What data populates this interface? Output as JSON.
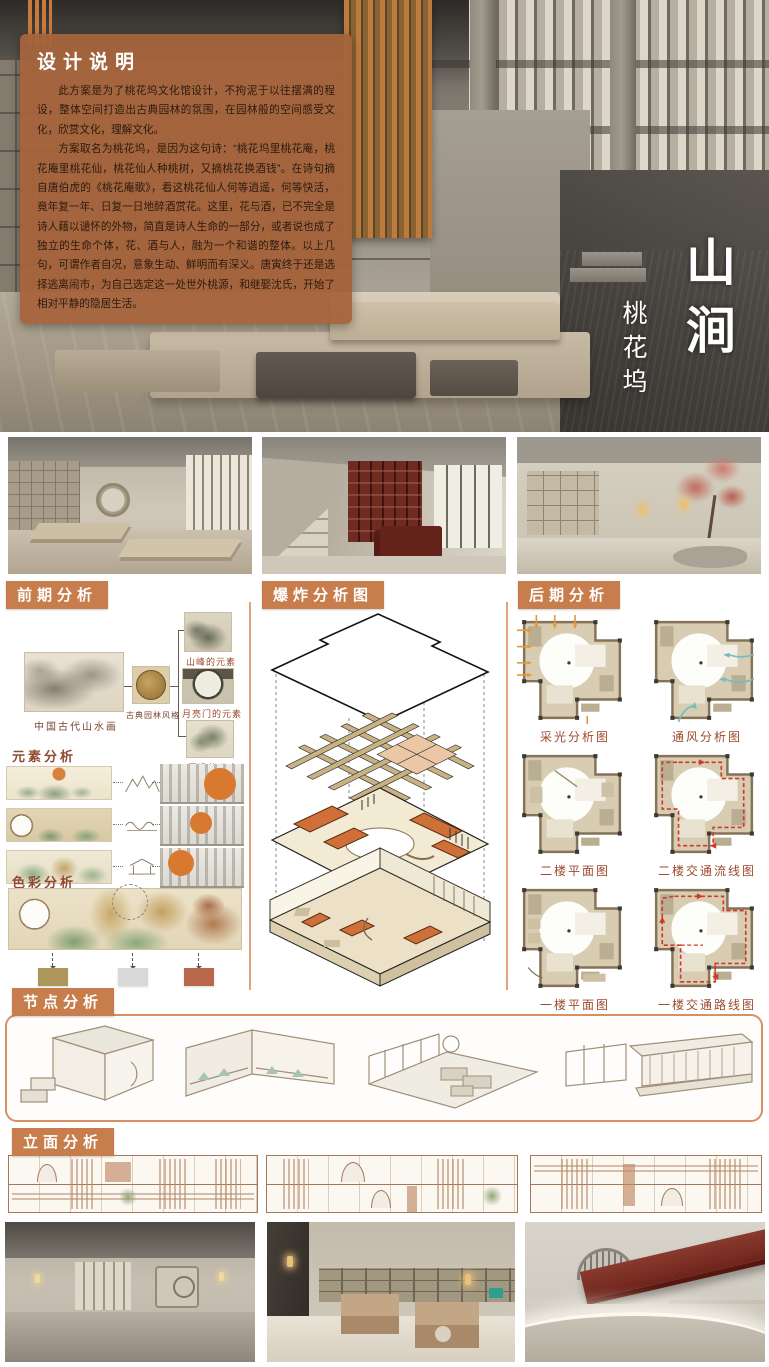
{
  "colors": {
    "accent_badge": "#c87d4c",
    "brief_panel": "#a6643c",
    "caption_text": "#9b4a2c",
    "exploded_roof_orange": "#cf7038",
    "divider_orange": "#dc9468"
  },
  "brief": {
    "title": "设计说明",
    "p1": "此方案是为了桃花坞文化馆设计，不拘泥于以往摆满的程设，整体空间打造出古典园林的氛围，在园林般的空间感受文化，欣赏文化，理解文化。",
    "p2": "方案取名为桃花坞，是因为这句诗：“桃花坞里桃花庵，桃花庵里桃花仙，桃花仙人种桃树，又摘桃花换酒钱”。在诗句摘自唐伯虎的《桃花庵歌》，看这桃花仙人何等逍遥，何等快活，竟年复一年、日复一日地醉酒赏花。这里，花与酒，已不完全是诗人藉以谴怀的外物，简直是诗人生命的一部分，或者说也成了独立的生命个体，花、酒与人，融为一个和谐的整体。以上几句，可谓作者自况，意象生动、鲜明而有深义。唐寅终于还是选择逃离闹市，为自己选定这一处世外桃源，和继娶沈氏，开始了相对平静的隐居生活。"
  },
  "title": {
    "main": [
      "山",
      "涧"
    ],
    "sub": "桃花坞"
  },
  "sections": {
    "early": {
      "header": "前期分析",
      "reference": {
        "source_caption": "中国古代山水画",
        "style_caption": "古典园林风格",
        "element_captions": [
          "山峰的元素",
          "月亮门的元素",
          "屋檐的元素"
        ]
      },
      "element_label": "元素分析",
      "color_label": "色彩分析",
      "swatches": [
        "#ac9659",
        "#d8dad7",
        "#b8674a"
      ]
    },
    "exploded": {
      "header": "爆炸分析图"
    },
    "later": {
      "header": "后期分析",
      "plan_captions": [
        "采光分析图",
        "通风分析图",
        "二楼平面图",
        "二楼交通流线图",
        "一楼平面图",
        "一楼交通路线图"
      ]
    },
    "node": {
      "header": "节点分析"
    },
    "elevation": {
      "header": "立面分析"
    }
  }
}
